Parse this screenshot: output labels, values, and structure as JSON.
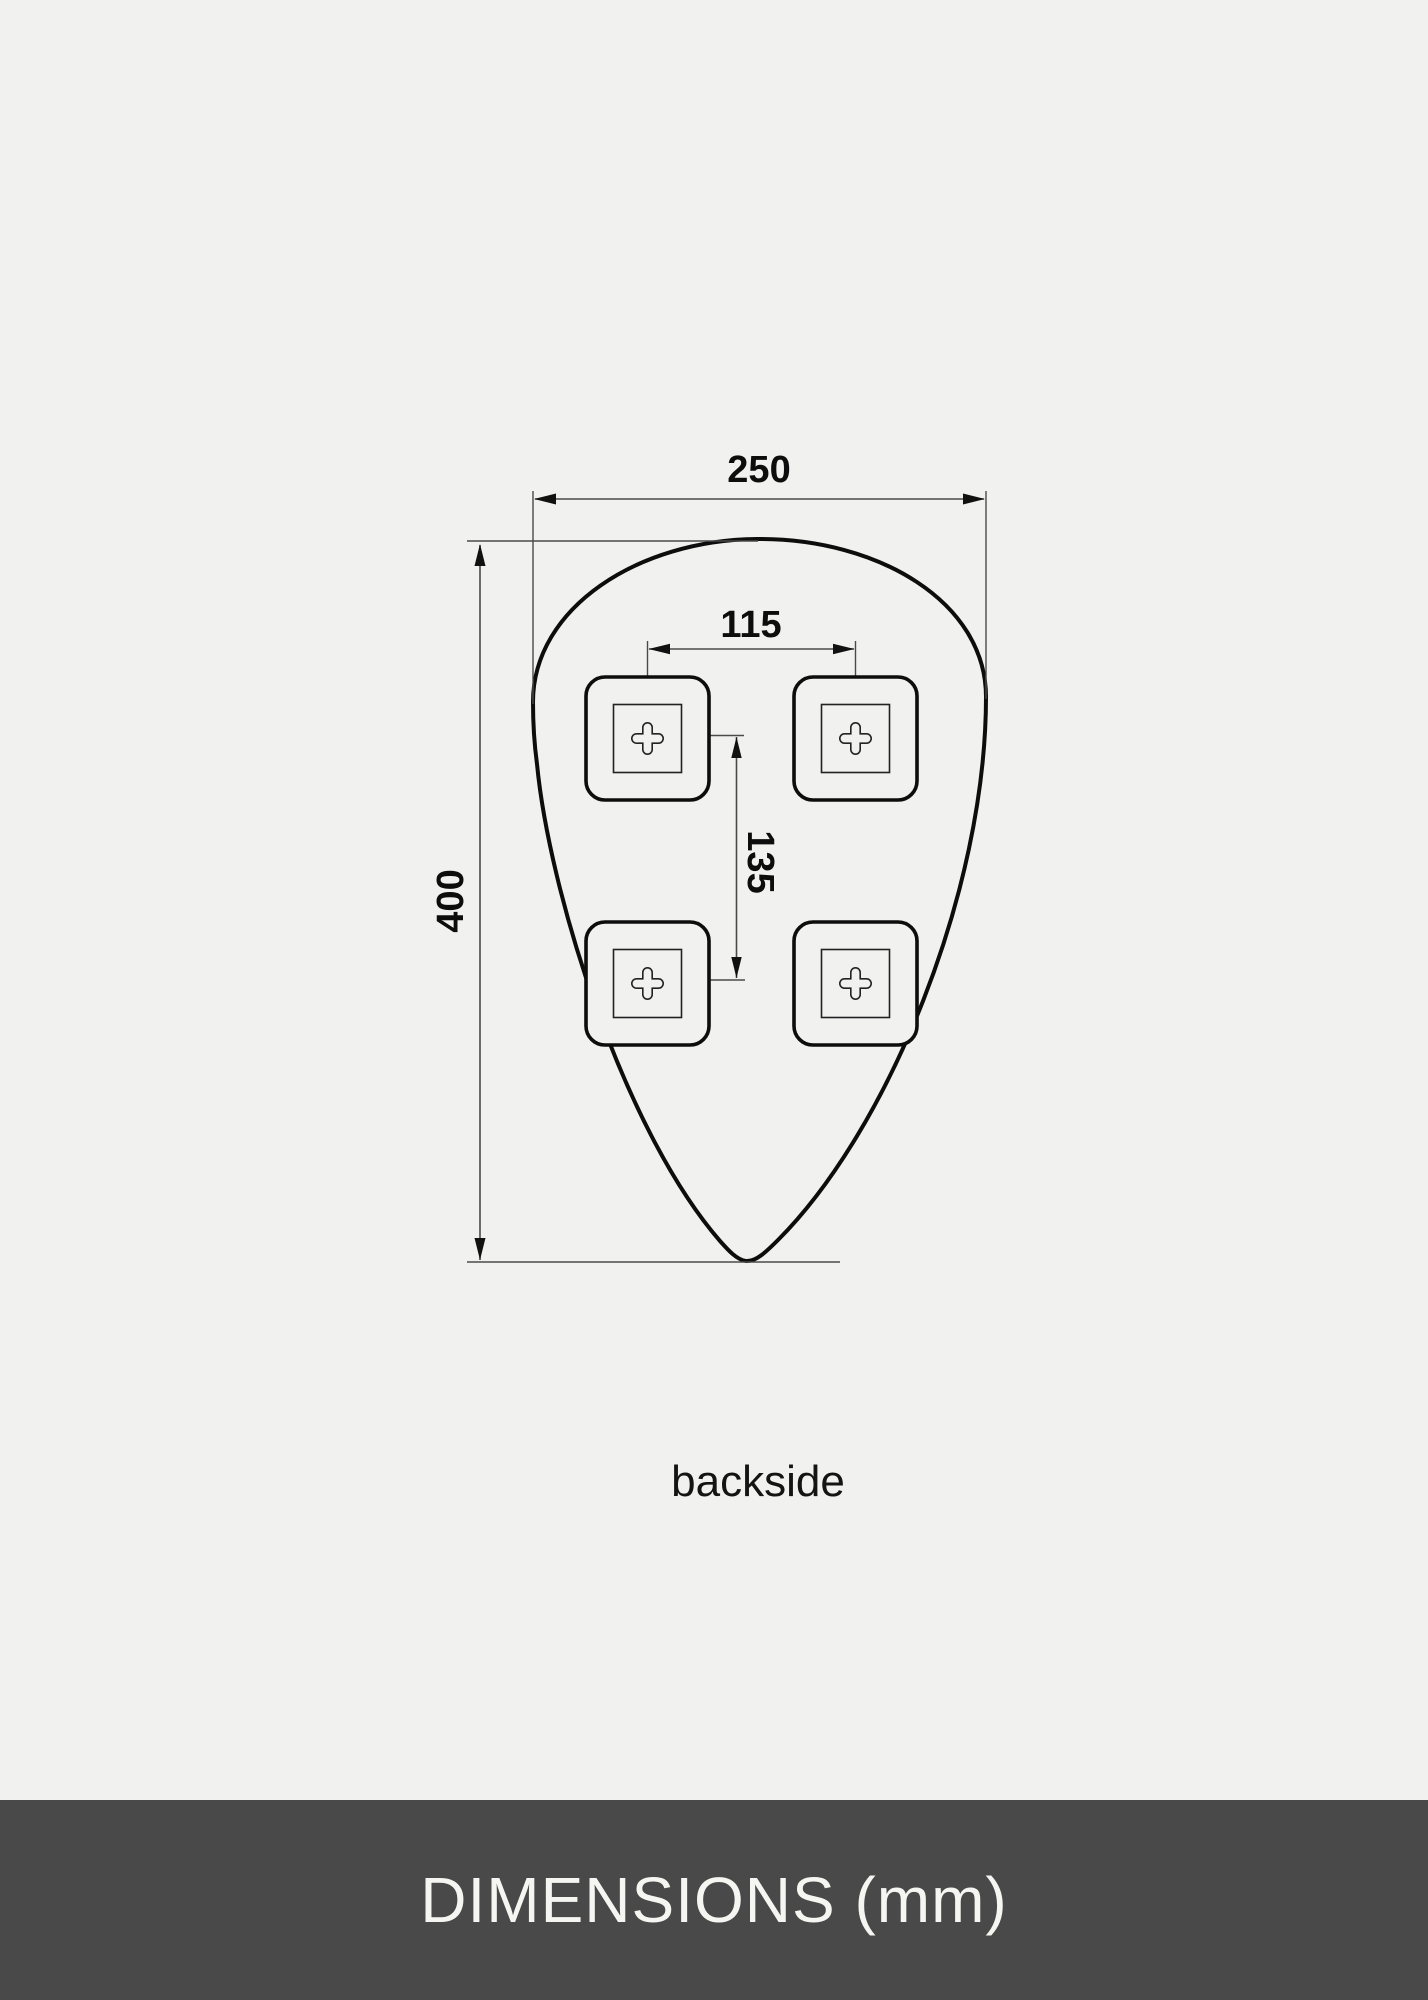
{
  "page": {
    "background_color": "#f1f1f0"
  },
  "drawing": {
    "caption": "backside",
    "dims": {
      "width": "250",
      "height": "400",
      "bracket_spacing_horizontal": "115",
      "bracket_spacing_vertical": "135"
    },
    "bracket_count": 4,
    "line_color": "#0d0d0d",
    "dim_line_color": "#4a4a4a"
  },
  "footer": {
    "label": "DIMENSIONS (mm)",
    "background_color": "#494949",
    "text_color": "#f5f5f2"
  }
}
